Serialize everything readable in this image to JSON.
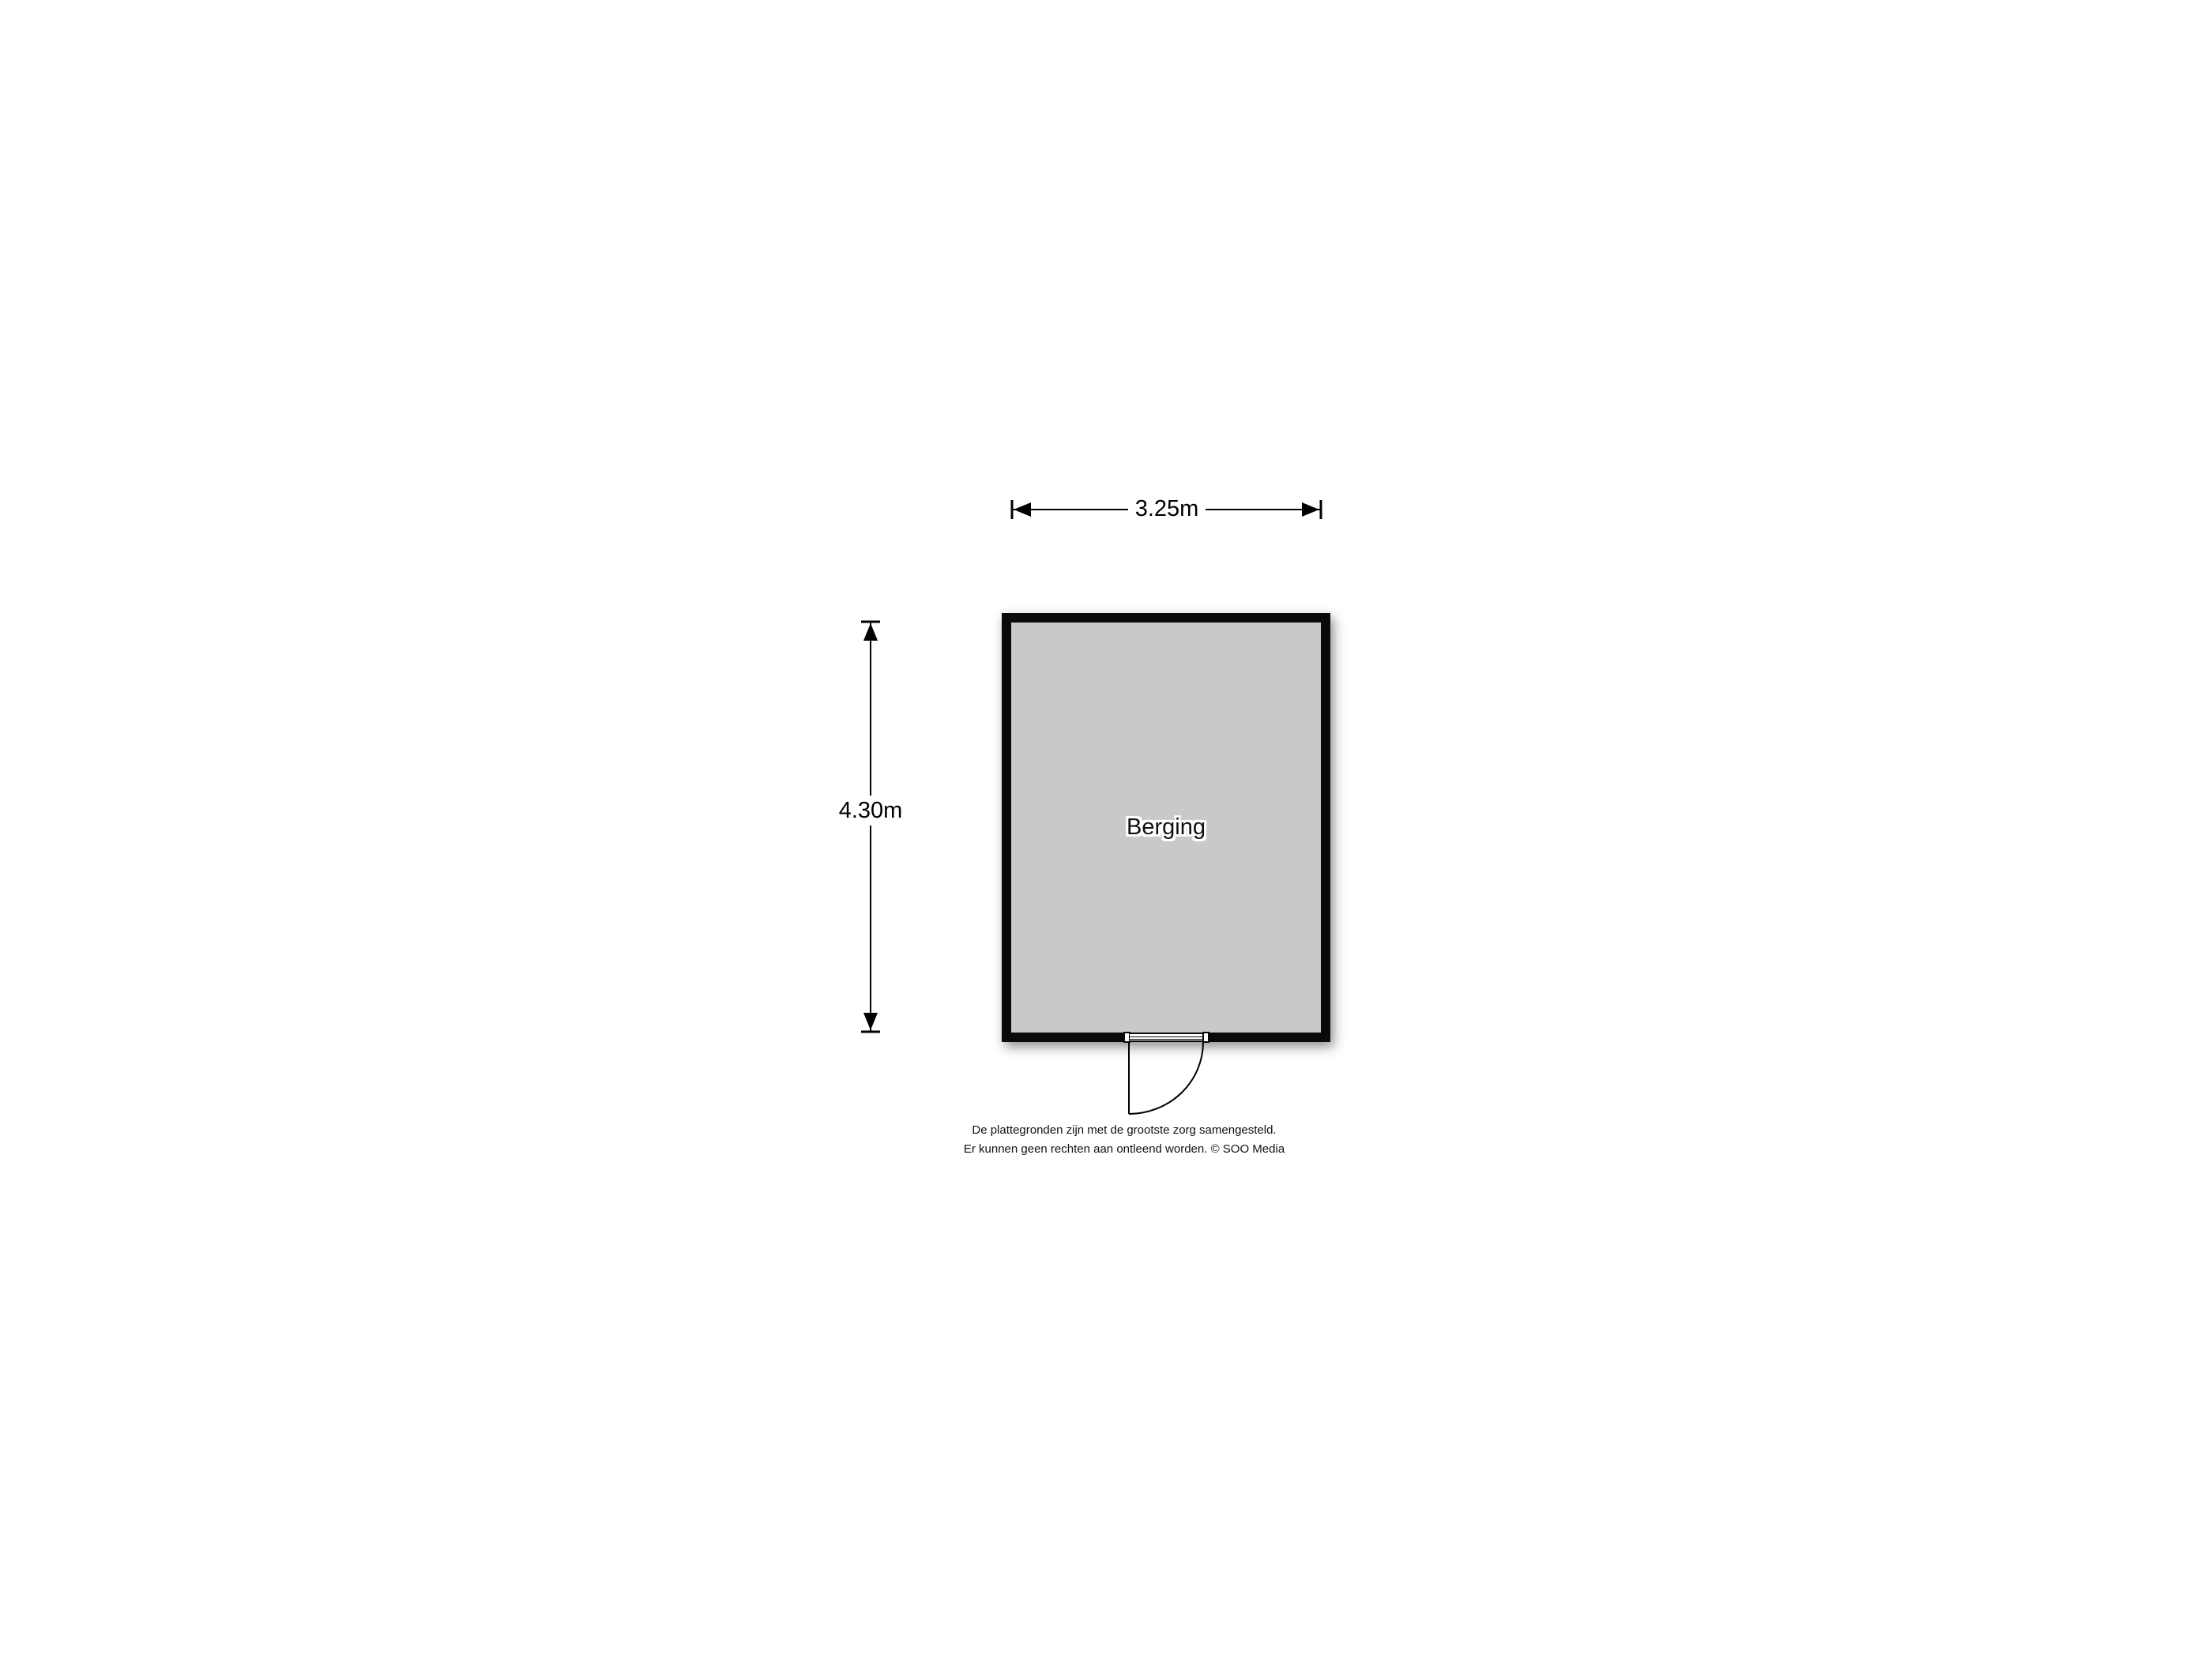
{
  "floorplan": {
    "room": {
      "name": "Berging",
      "width_label": "3.25m",
      "height_label": "4.30m"
    },
    "colors": {
      "wall": "#0a0a0a",
      "room_fill": "#c9c9c9",
      "line": "#000000",
      "background": "#ffffff"
    },
    "disclaimer": {
      "line1": "De plattegronden zijn met de grootste zorg samengesteld.",
      "line2": "Er kunnen geen rechten aan ontleend worden. © SOO Media"
    }
  }
}
